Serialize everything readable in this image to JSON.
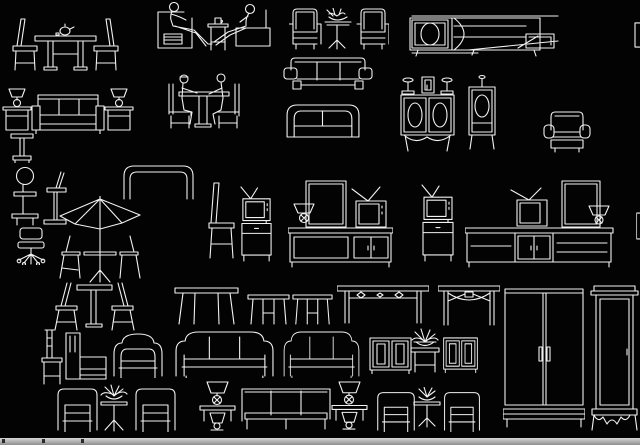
{
  "app": {
    "kind": "cad-block-library-canvas",
    "background": "#030303",
    "line_color": "#f2f2f2",
    "bottom_strip": {
      "color_top": "#d6d6d6",
      "color_bottom": "#8f8f8f",
      "tick_color": "#2a2a2a",
      "ticks_x": [
        2,
        42,
        81
      ]
    }
  },
  "canvas": {
    "width": 640,
    "height": 438,
    "items": [
      {
        "name": "dining-table-two-chairs",
        "shape": "dining-set",
        "x": 8,
        "y": 16,
        "w": 115,
        "h": 60
      },
      {
        "name": "sofa-with-lamp-tables",
        "shape": "sofa-lamps",
        "x": 2,
        "y": 82,
        "w": 132,
        "h": 52
      },
      {
        "name": "pedestal-stool",
        "shape": "stool-ped",
        "x": 10,
        "y": 133,
        "w": 24,
        "h": 30
      },
      {
        "name": "people-seated-armchair-scene",
        "shape": "person-scene",
        "x": 156,
        "y": 2,
        "w": 116,
        "h": 50
      },
      {
        "name": "two-people-at-table",
        "shape": "people-table",
        "x": 157,
        "y": 66,
        "w": 93,
        "h": 64
      },
      {
        "name": "two-armchairs-round-table",
        "shape": "armchair-pair-table",
        "x": 289,
        "y": 8,
        "w": 100,
        "h": 42
      },
      {
        "name": "sofa-three-seat",
        "shape": "sofa-arms",
        "x": 283,
        "y": 56,
        "w": 90,
        "h": 35
      },
      {
        "name": "sofa-two-seat",
        "shape": "sofa-round",
        "x": 281,
        "y": 100,
        "w": 84,
        "h": 38
      },
      {
        "name": "tv-sideboard-long",
        "shape": "tv-sideboard",
        "x": 408,
        "y": 10,
        "w": 152,
        "h": 48
      },
      {
        "name": "clipped-block-right",
        "shape": "edge-cut",
        "x": 634,
        "y": 22,
        "w": 6,
        "h": 26
      },
      {
        "name": "cabinet-oval-doors",
        "shape": "cabinet-ovals",
        "x": 399,
        "y": 73,
        "w": 57,
        "h": 80
      },
      {
        "name": "cabinet-single-oval",
        "shape": "cabinet-oval1",
        "x": 466,
        "y": 73,
        "w": 32,
        "h": 78
      },
      {
        "name": "club-armchair",
        "shape": "armchair-small",
        "x": 543,
        "y": 110,
        "w": 48,
        "h": 43
      },
      {
        "name": "round-back-stool",
        "shape": "rack-circle",
        "x": 10,
        "y": 165,
        "w": 30,
        "h": 62
      },
      {
        "name": "tall-stool",
        "shape": "stool-tall",
        "x": 42,
        "y": 171,
        "w": 26,
        "h": 57
      },
      {
        "name": "office-swivel-chair",
        "shape": "office-chair",
        "x": 15,
        "y": 227,
        "w": 32,
        "h": 38
      },
      {
        "name": "patio-umbrella-table-set",
        "shape": "umbrella-set",
        "x": 58,
        "y": 196,
        "w": 84,
        "h": 88
      },
      {
        "name": "curved-bench",
        "shape": "bench-curve",
        "x": 122,
        "y": 162,
        "w": 73,
        "h": 38
      },
      {
        "name": "side-chair",
        "shape": "chair-side",
        "x": 206,
        "y": 182,
        "w": 32,
        "h": 79
      },
      {
        "name": "tv-on-cabinet",
        "shape": "tv-stand",
        "x": 239,
        "y": 186,
        "w": 35,
        "h": 76
      },
      {
        "name": "dresser-mirror-tv-set",
        "shape": "dresser-set-a",
        "x": 288,
        "y": 180,
        "w": 105,
        "h": 88
      },
      {
        "name": "tv-on-cabinet",
        "shape": "tv-stand",
        "x": 420,
        "y": 184,
        "w": 36,
        "h": 78
      },
      {
        "name": "dresser-mirror-tv-set-wide",
        "shape": "dresser-set-b",
        "x": 465,
        "y": 180,
        "w": 150,
        "h": 88
      },
      {
        "name": "clipped-block-right",
        "shape": "edge-cut",
        "x": 636,
        "y": 212,
        "w": 4,
        "h": 28
      },
      {
        "name": "table-with-two-chairs",
        "shape": "table-2chairs",
        "x": 52,
        "y": 282,
        "w": 85,
        "h": 50
      },
      {
        "name": "long-dining-table",
        "shape": "table-long",
        "x": 173,
        "y": 286,
        "w": 67,
        "h": 40
      },
      {
        "name": "small-table",
        "shape": "table-small",
        "x": 247,
        "y": 293,
        "w": 43,
        "h": 33
      },
      {
        "name": "small-table",
        "shape": "table-small",
        "x": 292,
        "y": 293,
        "w": 41,
        "h": 33
      },
      {
        "name": "console-table-diamond-apron",
        "shape": "console-table",
        "x": 337,
        "y": 285,
        "w": 92,
        "h": 40
      },
      {
        "name": "console-table-arched-apron",
        "shape": "console-arch",
        "x": 438,
        "y": 285,
        "w": 62,
        "h": 42
      },
      {
        "name": "wardrobe-two-door",
        "shape": "wardrobe-2door",
        "x": 503,
        "y": 287,
        "w": 82,
        "h": 141
      },
      {
        "name": "wardrobe-with-cornice",
        "shape": "wardrobe-cornice",
        "x": 589,
        "y": 285,
        "w": 51,
        "h": 147
      },
      {
        "name": "ladder-back-chair",
        "shape": "chair-tall",
        "x": 40,
        "y": 329,
        "w": 24,
        "h": 57
      },
      {
        "name": "boxy-armchair",
        "shape": "armchair-boxy",
        "x": 64,
        "y": 331,
        "w": 44,
        "h": 50
      },
      {
        "name": "rounded-armchair",
        "shape": "armchair-round",
        "x": 109,
        "y": 329,
        "w": 59,
        "h": 49
      },
      {
        "name": "rounded-sofa-three-seat",
        "shape": "sofa-round3",
        "x": 172,
        "y": 329,
        "w": 105,
        "h": 49
      },
      {
        "name": "rounded-sofa-three-seat",
        "shape": "sofa-round3",
        "x": 281,
        "y": 329,
        "w": 81,
        "h": 49
      },
      {
        "name": "small-cabinet",
        "shape": "cabinet-sm",
        "x": 368,
        "y": 336,
        "w": 45,
        "h": 38
      },
      {
        "name": "plant-on-table",
        "shape": "plant-table",
        "x": 407,
        "y": 327,
        "w": 36,
        "h": 47
      },
      {
        "name": "small-cabinet",
        "shape": "cabinet-sm",
        "x": 442,
        "y": 336,
        "w": 37,
        "h": 37
      },
      {
        "name": "lounge-armchair",
        "shape": "armchair-low",
        "x": 54,
        "y": 385,
        "w": 47,
        "h": 47
      },
      {
        "name": "plant-pedestal-table",
        "shape": "plant-ped-table",
        "x": 96,
        "y": 384,
        "w": 36,
        "h": 48
      },
      {
        "name": "lounge-armchair",
        "shape": "armchair-low",
        "x": 132,
        "y": 385,
        "w": 47,
        "h": 47
      },
      {
        "name": "lamp-on-stand",
        "shape": "lamp-stand",
        "x": 197,
        "y": 381,
        "w": 41,
        "h": 51
      },
      {
        "name": "three-seat-bench",
        "shape": "bench3",
        "x": 239,
        "y": 387,
        "w": 94,
        "h": 44
      },
      {
        "name": "lamp-on-stand",
        "shape": "lamp-stand",
        "x": 329,
        "y": 381,
        "w": 41,
        "h": 50
      },
      {
        "name": "lounge-armchair",
        "shape": "armchair-low",
        "x": 374,
        "y": 389,
        "w": 44,
        "h": 43
      },
      {
        "name": "plant-round-table",
        "shape": "plant-round-table",
        "x": 411,
        "y": 387,
        "w": 32,
        "h": 41
      },
      {
        "name": "lounge-armchair",
        "shape": "armchair-low",
        "x": 441,
        "y": 389,
        "w": 42,
        "h": 43
      }
    ]
  }
}
